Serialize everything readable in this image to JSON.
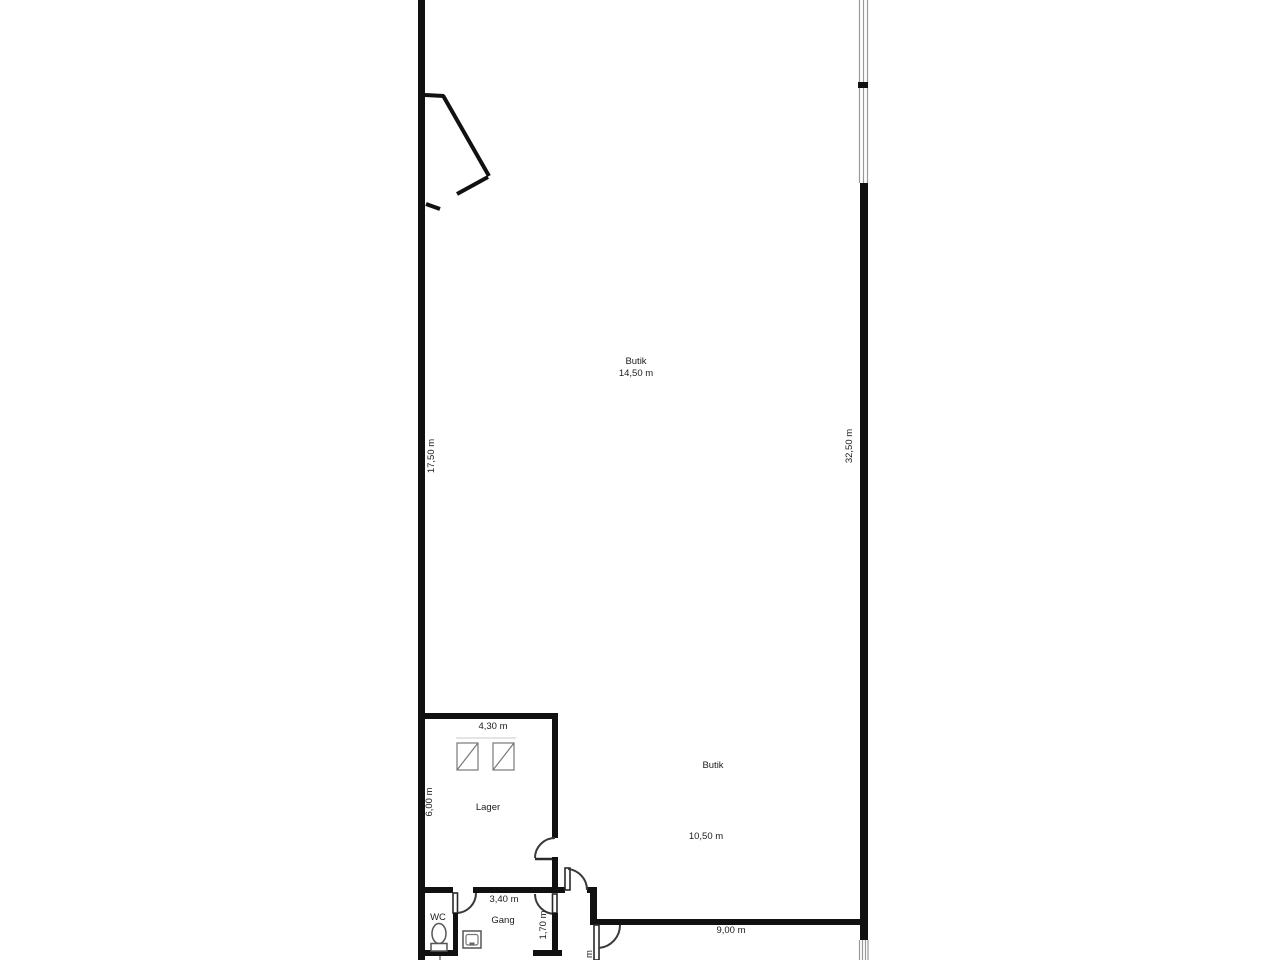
{
  "plan": {
    "rooms": {
      "butik_upper": {
        "label": "Butik",
        "dim": "14,50 m"
      },
      "butik_lower": {
        "label": "Butik",
        "dim": "10,50 m"
      },
      "lager": {
        "label": "Lager",
        "width_dim": "4,30 m",
        "height_dim": "6,00 m"
      },
      "gang": {
        "label": "Gang",
        "width_dim": "3,40 m"
      },
      "wc": {
        "label": "WC"
      }
    },
    "dims": {
      "left_wall": "17,50 m",
      "right_wall": "32,50 m",
      "bottom_wall": "9,00 m",
      "corridor": "1,70 m",
      "bottom_cutoff": "m"
    },
    "colors": {
      "wall": "#111111",
      "background": "#ffffff",
      "text": "#1c1c1c"
    }
  }
}
